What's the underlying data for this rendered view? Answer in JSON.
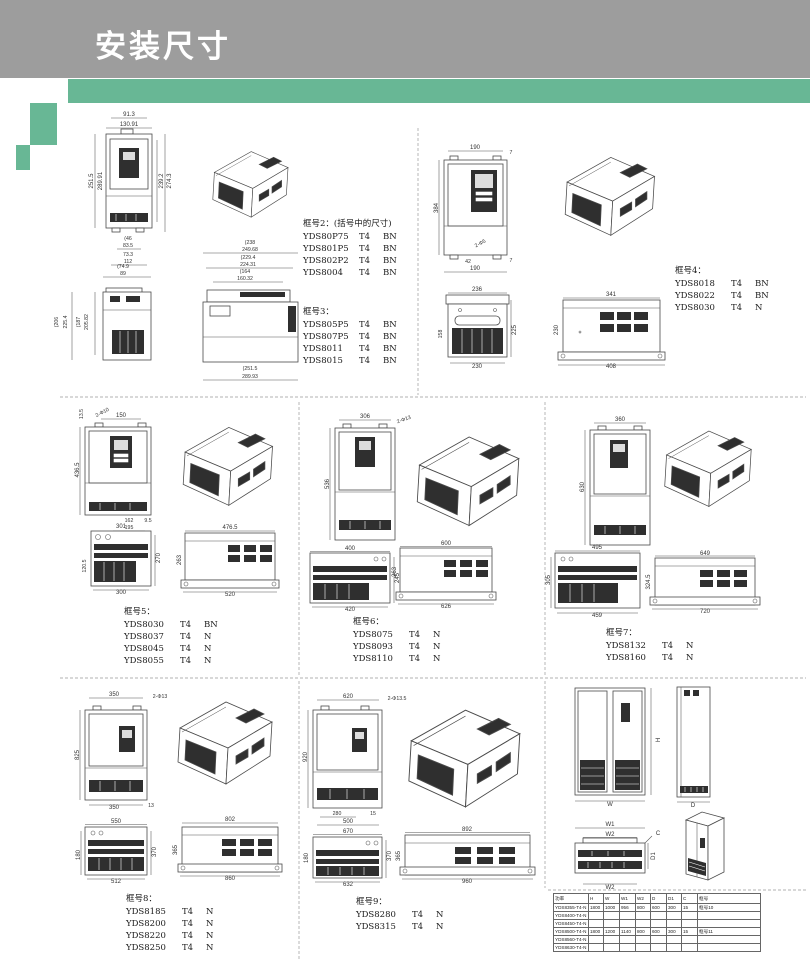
{
  "header": {
    "title": "安装尺寸"
  },
  "frames": {
    "f2": {
      "title": "框号2：(括号中的尺寸)",
      "rows": [
        [
          "YDS80P75",
          "T4",
          "BN"
        ],
        [
          "YDS801P5",
          "T4",
          "BN"
        ],
        [
          "YDS802P2",
          "T4",
          "BN"
        ],
        [
          "YDS8004",
          "T4",
          "BN"
        ]
      ]
    },
    "f3": {
      "title": "框号3：",
      "rows": [
        [
          "YDS805P5",
          "T4",
          "BN"
        ],
        [
          "YDS807P5",
          "T4",
          "BN"
        ],
        [
          "YDS8011",
          "T4",
          "BN"
        ],
        [
          "YDS8015",
          "T4",
          "BN"
        ]
      ]
    },
    "f4": {
      "title": "框号4：",
      "rows": [
        [
          "YDS8018",
          "T4",
          "BN"
        ],
        [
          "YDS8022",
          "T4",
          "BN"
        ],
        [
          "YDS8030",
          "T4",
          "N"
        ]
      ]
    },
    "f5": {
      "title": "框号5：",
      "rows": [
        [
          "YDS8030",
          "T4",
          "BN"
        ],
        [
          "YDS8037",
          "T4",
          "N"
        ],
        [
          "YDS8045",
          "T4",
          "N"
        ],
        [
          "YDS8055",
          "T4",
          "N"
        ]
      ]
    },
    "f6": {
      "title": "框号6：",
      "rows": [
        [
          "YDS8075",
          "T4",
          "N"
        ],
        [
          "YDS8093",
          "T4",
          "N"
        ],
        [
          "YDS8110",
          "T4",
          "N"
        ]
      ]
    },
    "f7": {
      "title": "框号7：",
      "rows": [
        [
          "YDS8132",
          "T4",
          "N"
        ],
        [
          "YDS8160",
          "T4",
          "N"
        ]
      ]
    },
    "f8": {
      "title": "框号8：",
      "rows": [
        [
          "YDS8185",
          "T4",
          "N"
        ],
        [
          "YDS8200",
          "T4",
          "N"
        ],
        [
          "YDS8220",
          "T4",
          "N"
        ],
        [
          "YDS8250",
          "T4",
          "N"
        ]
      ]
    },
    "f9": {
      "title": "框号9：",
      "rows": [
        [
          "YDS8280",
          "T4",
          "N"
        ],
        [
          "YDS8315",
          "T4",
          "N"
        ]
      ]
    }
  },
  "dims": {
    "a": {
      "front": {
        "t1": "91.3",
        "t2": "130.91",
        "l1": "251.5",
        "l2": "289.91",
        "r1": "239.2",
        "r2": "274.3",
        "b1": "(46",
        "b2": "83.5",
        "b3": "73.3",
        "b4": "112"
      },
      "side_small": {
        "t1": "(74.9",
        "t2": "89",
        "l1": "(206",
        "l2": "225.4",
        "l3": "(187",
        "l4": "205.82"
      },
      "side_large": {
        "t1": "(238",
        "t2": "249.68",
        "t3": "(229.4",
        "t4": "224.31",
        "t5": "(164",
        "t6": "160.32",
        "b1": "(251.5",
        "b2": "289.93"
      }
    },
    "b": {
      "front": {
        "t1": "190",
        "t2": "7",
        "l1": "384",
        "note": "2-Φ5",
        "b1": "42",
        "b2": "7",
        "b3": "190"
      },
      "bl": {
        "t1": "236",
        "l1": "158",
        "r1": "225",
        "b1": "230"
      },
      "br": {
        "t1": "341",
        "l1": "230",
        "b1": "408"
      }
    },
    "c": {
      "front": {
        "t1": "13.5",
        "note": "2-Φ10",
        "t2": "150",
        "l1": "436.5",
        "b1": "162",
        "b2": "195",
        "b3": "9.5"
      },
      "bl": {
        "t1": "301",
        "l1": "120.5",
        "r1": "270",
        "b1": "300"
      },
      "br": {
        "t1": "476.5",
        "l1": "263",
        "b1": "520"
      }
    },
    "d": {
      "front": {
        "t1": "306",
        "note": "2-Φ13",
        "l1": "536"
      },
      "bl": {
        "t1": "400",
        "r1": "245",
        "b1": "420"
      },
      "br": {
        "t1": "600",
        "l1": "263",
        "b1": "626"
      }
    },
    "e": {
      "front": {
        "t1": "360",
        "l1": "630"
      },
      "bl": {
        "t1": "495",
        "l1": "305",
        "b1": "459"
      },
      "br": {
        "t1": "649",
        "l1": "324.5",
        "b1": "720"
      }
    },
    "f": {
      "front": {
        "t1": "350",
        "note": "2-Φ13",
        "l1": "825",
        "b1": "350",
        "b2": "13"
      },
      "bl": {
        "t1": "550",
        "l1": "180",
        "r1": "370",
        "b1": "512"
      },
      "br": {
        "t1": "802",
        "l1": "365",
        "b1": "860"
      }
    },
    "g": {
      "front": {
        "t1": "620",
        "note": "2-Φ13.5",
        "l1": "920",
        "b1": "280",
        "b2": "500",
        "b3": "15"
      },
      "bl": {
        "t1": "670",
        "l1": "180",
        "r1": "370",
        "b1": "632"
      },
      "br": {
        "t1": "892",
        "l1": "365",
        "b1": "960"
      }
    },
    "h": {
      "front_h": "H",
      "front_w": "W",
      "side_d": "D",
      "w1": "W1",
      "w2": "W2",
      "c": "C",
      "d1": "D1",
      "w2b": "W2"
    }
  },
  "table": {
    "headers": [
      "功率",
      "H",
      "W",
      "W1",
      "W2",
      "D",
      "D1",
      "C",
      "框号"
    ],
    "rows": [
      [
        "YDS8355-T4-N",
        "1800",
        "1000",
        "956",
        "800",
        "600",
        "300",
        "15",
        "框号10"
      ],
      [
        "YDS8400-T4-N",
        "",
        "",
        "",
        "",
        "",
        "",
        "",
        ""
      ],
      [
        "YDS8450-T4-N",
        "",
        "",
        "",
        "",
        "",
        "",
        "",
        ""
      ],
      [
        "YDS8500-T4-N",
        "1800",
        "1200",
        "1140",
        "800",
        "600",
        "300",
        "15",
        "框号11"
      ],
      [
        "YDS8560-T4-N",
        "",
        "",
        "",
        "",
        "",
        "",
        "",
        ""
      ],
      [
        "YDS8630-T4-N",
        "",
        "",
        "",
        "",
        "",
        "",
        "",
        ""
      ]
    ]
  },
  "colors": {
    "header_gray": "#9d9d9d",
    "accent_green": "#68b795"
  }
}
